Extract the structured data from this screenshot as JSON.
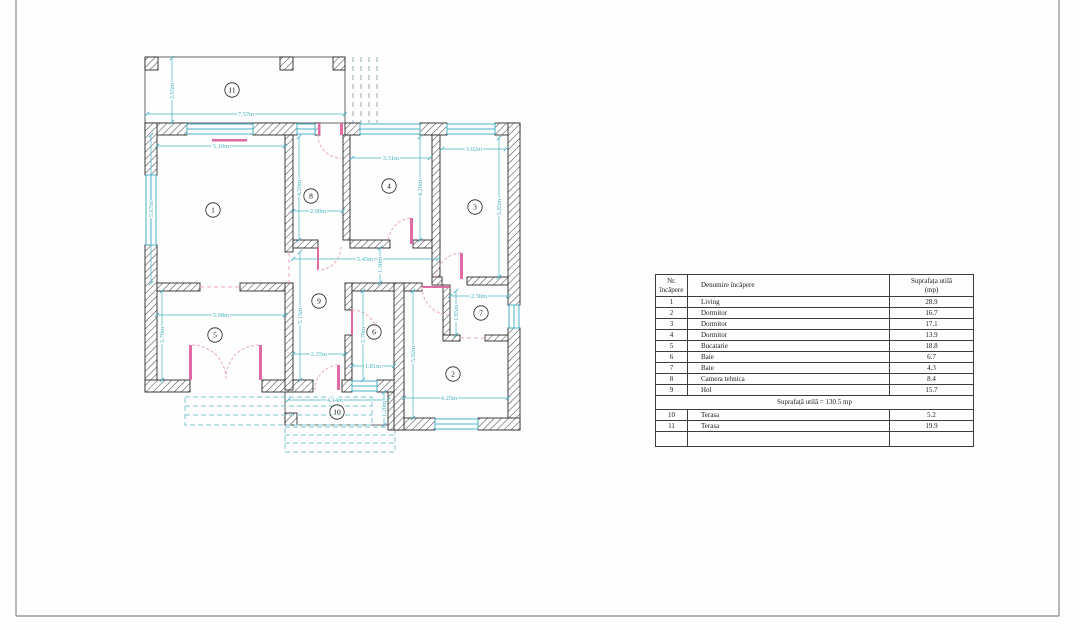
{
  "colors": {
    "dimension": "#48b2c6",
    "window": "#48b2c6",
    "door": "#e06ba4",
    "door_arc": "#f0a6c4",
    "steps": "#7bc4ce",
    "wall_outline": "#2a2a2a",
    "frame": "#9b9b9b"
  },
  "table": {
    "headers": {
      "nr_line1": "Nr.",
      "nr_line2": "încăpere",
      "name": "Denumire încăpere",
      "area_line1": "Suprafața utilă",
      "area_line2": "(mp)"
    },
    "rows": [
      {
        "nr": "1",
        "name": "Living",
        "area": "28.9"
      },
      {
        "nr": "2",
        "name": "Dormitor",
        "area": "16.7"
      },
      {
        "nr": "3",
        "name": "Dormitor",
        "area": "17.1"
      },
      {
        "nr": "4",
        "name": "Dormitor",
        "area": "13.9"
      },
      {
        "nr": "5",
        "name": "Bucatarie",
        "area": "18.8"
      },
      {
        "nr": "6",
        "name": "Baie",
        "area": "6.7"
      },
      {
        "nr": "7",
        "name": "Baie",
        "area": "4.3"
      },
      {
        "nr": "8",
        "name": "Camera tehnica",
        "area": "8.4"
      },
      {
        "nr": "9",
        "name": "Hol",
        "area": "15.7"
      }
    ],
    "summary": "Suprafață utilă = 130.5 mp",
    "extra_rows": [
      {
        "nr": "10",
        "name": "Terasa",
        "area": "5.2"
      },
      {
        "nr": "11",
        "name": "Terasa",
        "area": "19.9"
      }
    ]
  },
  "plan": {
    "colors": {
      "dimension": "#48b2c6"
    },
    "rooms": [
      {
        "n": "1",
        "x": 213,
        "y": 210
      },
      {
        "n": "2",
        "x": 453,
        "y": 374
      },
      {
        "n": "3",
        "x": 475,
        "y": 207
      },
      {
        "n": "4",
        "x": 389,
        "y": 186
      },
      {
        "n": "5",
        "x": 215,
        "y": 335
      },
      {
        "n": "6",
        "x": 374,
        "y": 332
      },
      {
        "n": "7",
        "x": 481,
        "y": 313
      },
      {
        "n": "8",
        "x": 311,
        "y": 196
      },
      {
        "n": "9",
        "x": 319,
        "y": 301
      },
      {
        "n": "10",
        "x": 337,
        "y": 412
      },
      {
        "n": "11",
        "x": 232,
        "y": 90
      }
    ],
    "dimensions": [
      {
        "t": "2.65m",
        "x1": 172,
        "y1": 58,
        "x2": 172,
        "y2": 122,
        "lx": 172,
        "ly": 91,
        "v": 1
      },
      {
        "t": "7.57m",
        "x1": 147,
        "y1": 114,
        "x2": 345,
        "y2": 114,
        "lx": 246,
        "ly": 114,
        "v": 0
      },
      {
        "t": "5.10m",
        "x1": 157,
        "y1": 146,
        "x2": 285,
        "y2": 146,
        "lx": 221,
        "ly": 146,
        "v": 0
      },
      {
        "t": "5.67m",
        "x1": 151,
        "y1": 135,
        "x2": 151,
        "y2": 283,
        "lx": 151,
        "ly": 209,
        "v": 1
      },
      {
        "t": "4.20m",
        "x1": 299,
        "y1": 137,
        "x2": 299,
        "y2": 240,
        "lx": 299,
        "ly": 188,
        "v": 1
      },
      {
        "t": "2.00m",
        "x1": 293,
        "y1": 211,
        "x2": 343,
        "y2": 211,
        "lx": 318,
        "ly": 211,
        "v": 0
      },
      {
        "t": "3.31m",
        "x1": 352,
        "y1": 158,
        "x2": 430,
        "y2": 158,
        "lx": 391,
        "ly": 158,
        "v": 0
      },
      {
        "t": "4.20m",
        "x1": 420,
        "y1": 137,
        "x2": 420,
        "y2": 240,
        "lx": 420,
        "ly": 188,
        "v": 1
      },
      {
        "t": "3.02m",
        "x1": 442,
        "y1": 149,
        "x2": 506,
        "y2": 149,
        "lx": 474,
        "ly": 149,
        "v": 0
      },
      {
        "t": "5.65m",
        "x1": 499,
        "y1": 138,
        "x2": 499,
        "y2": 277,
        "lx": 499,
        "ly": 207,
        "v": 1
      },
      {
        "t": "5.45m",
        "x1": 293,
        "y1": 259,
        "x2": 438,
        "y2": 259,
        "lx": 365,
        "ly": 259,
        "v": 0
      },
      {
        "t": "1.30m",
        "x1": 380,
        "y1": 248,
        "x2": 380,
        "y2": 283,
        "lx": 380,
        "ly": 265,
        "v": 1
      },
      {
        "t": "5.15m",
        "x1": 300,
        "y1": 252,
        "x2": 300,
        "y2": 380,
        "lx": 300,
        "ly": 316,
        "v": 1
      },
      {
        "t": "2.25m",
        "x1": 293,
        "y1": 354,
        "x2": 345,
        "y2": 354,
        "lx": 319,
        "ly": 354,
        "v": 0
      },
      {
        "t": "3.70m",
        "x1": 363,
        "y1": 291,
        "x2": 363,
        "y2": 380,
        "lx": 363,
        "ly": 335,
        "v": 1
      },
      {
        "t": "1.81m",
        "x1": 352,
        "y1": 366,
        "x2": 394,
        "y2": 366,
        "lx": 373,
        "ly": 366,
        "v": 0
      },
      {
        "t": "5.02m",
        "x1": 413,
        "y1": 291,
        "x2": 413,
        "y2": 418,
        "lx": 413,
        "ly": 354,
        "v": 1
      },
      {
        "t": "2.30m",
        "x1": 450,
        "y1": 296,
        "x2": 508,
        "y2": 296,
        "lx": 479,
        "ly": 296,
        "v": 0
      },
      {
        "t": "1.85m",
        "x1": 456,
        "y1": 291,
        "x2": 456,
        "y2": 335,
        "lx": 456,
        "ly": 313,
        "v": 1
      },
      {
        "t": "4.25m",
        "x1": 404,
        "y1": 398,
        "x2": 508,
        "y2": 398,
        "lx": 449,
        "ly": 398,
        "v": 0
      },
      {
        "t": "5.08m",
        "x1": 157,
        "y1": 315,
        "x2": 285,
        "y2": 315,
        "lx": 221,
        "ly": 315,
        "v": 0
      },
      {
        "t": "3.70m",
        "x1": 162,
        "y1": 291,
        "x2": 162,
        "y2": 380,
        "lx": 162,
        "ly": 335,
        "v": 1
      },
      {
        "t": "4.14m",
        "x1": 288,
        "y1": 400,
        "x2": 388,
        "y2": 400,
        "lx": 335,
        "ly": 400,
        "v": 0
      },
      {
        "t": "1.20m",
        "x1": 384,
        "y1": 392,
        "x2": 384,
        "y2": 425,
        "lx": 384,
        "ly": 409,
        "v": 1
      }
    ]
  }
}
